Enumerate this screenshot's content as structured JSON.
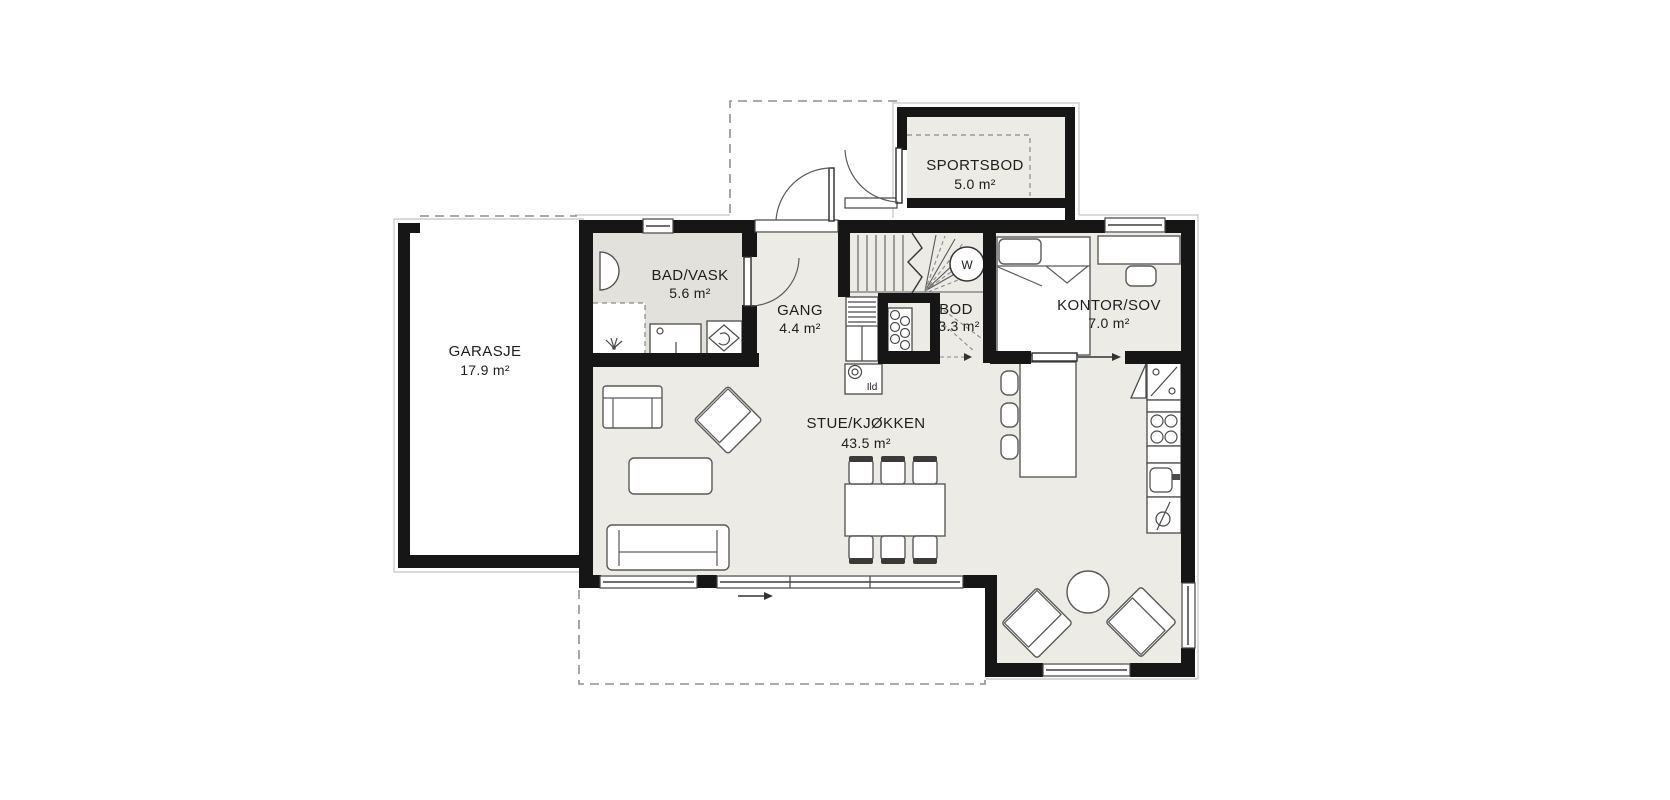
{
  "floor_plan": {
    "rooms": [
      {
        "id": "garasje",
        "name": "GARASJE",
        "area": "17.9 m²"
      },
      {
        "id": "bad-vask",
        "name": "BAD/VASK",
        "area": "5.6 m²"
      },
      {
        "id": "gang",
        "name": "GANG",
        "area": "4.4 m²"
      },
      {
        "id": "sportsbod",
        "name": "SPORTSBOD",
        "area": "5.0 m²"
      },
      {
        "id": "bod",
        "name": "BOD",
        "area": "3.3 m²"
      },
      {
        "id": "kontor-sov",
        "name": "KONTOR/SOV",
        "area": "7.0 m²"
      },
      {
        "id": "stue-kjokken",
        "name": "STUE/KJØKKEN",
        "area": "43.5 m²"
      }
    ],
    "annotations": {
      "fireplace": "Ild",
      "stair_circle": "W"
    },
    "colors": {
      "wall": "#161616",
      "floor": "#ecebe6",
      "floor_bathroom": "#e2e1dc",
      "dashed_line": "#8f8f8f",
      "furniture_outline": "#5a5a5a"
    }
  }
}
